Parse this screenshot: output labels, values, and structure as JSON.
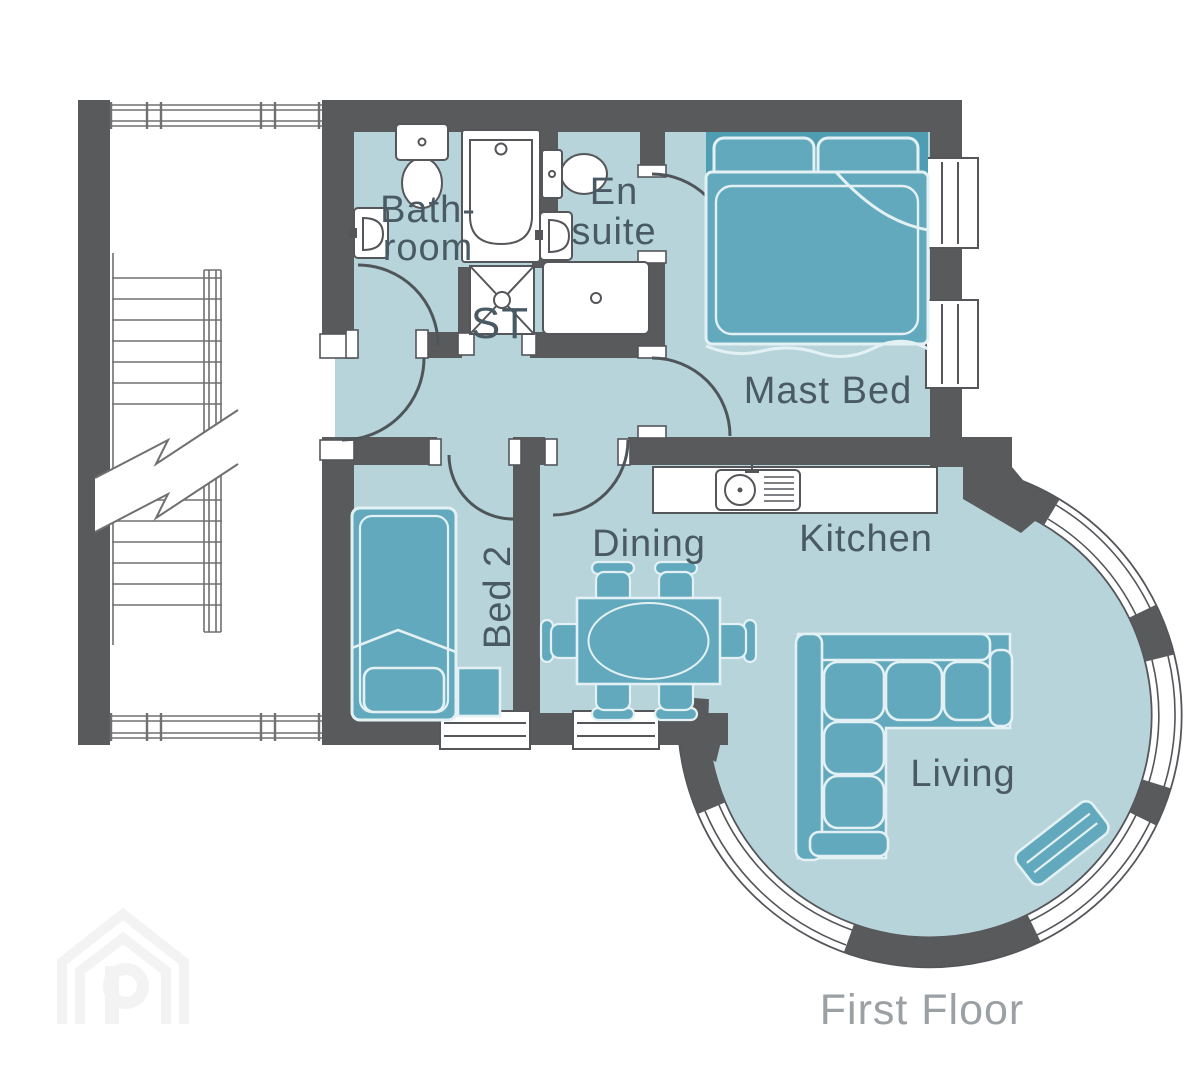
{
  "plan": {
    "floor_label": "First Floor",
    "rooms": [
      {
        "key": "bathroom",
        "line1": "Bath-",
        "line2": "room"
      },
      {
        "key": "en-suite",
        "line1": "En",
        "line2": "suite"
      },
      {
        "key": "storage",
        "label": "ST"
      },
      {
        "key": "master-bedroom",
        "label": "Mast Bed"
      },
      {
        "key": "bedroom-2",
        "label": "Bed 2"
      },
      {
        "key": "dining",
        "label": "Dining"
      },
      {
        "key": "kitchen",
        "label": "Kitchen"
      },
      {
        "key": "living",
        "label": "Living"
      }
    ],
    "watermark_letter": "P",
    "fixtures": [
      "toilet",
      "bath",
      "basin",
      "shower-tray",
      "kitchen-sink",
      "double-bed",
      "single-bed",
      "bedside-unit",
      "dining-table",
      "dining-chairs",
      "corner-sofa",
      "tv-unit",
      "staircase"
    ],
    "colors": {
      "wall": "#595a5c",
      "floor": "#b7d4db",
      "furniture": "#63a9bd",
      "furniture_dark": "#4e9db3",
      "furniture_outline": "#e3f1f4",
      "fixture_line": "#55565a",
      "label": "#4a5a64",
      "floor_label": "#9aa0a4"
    }
  }
}
